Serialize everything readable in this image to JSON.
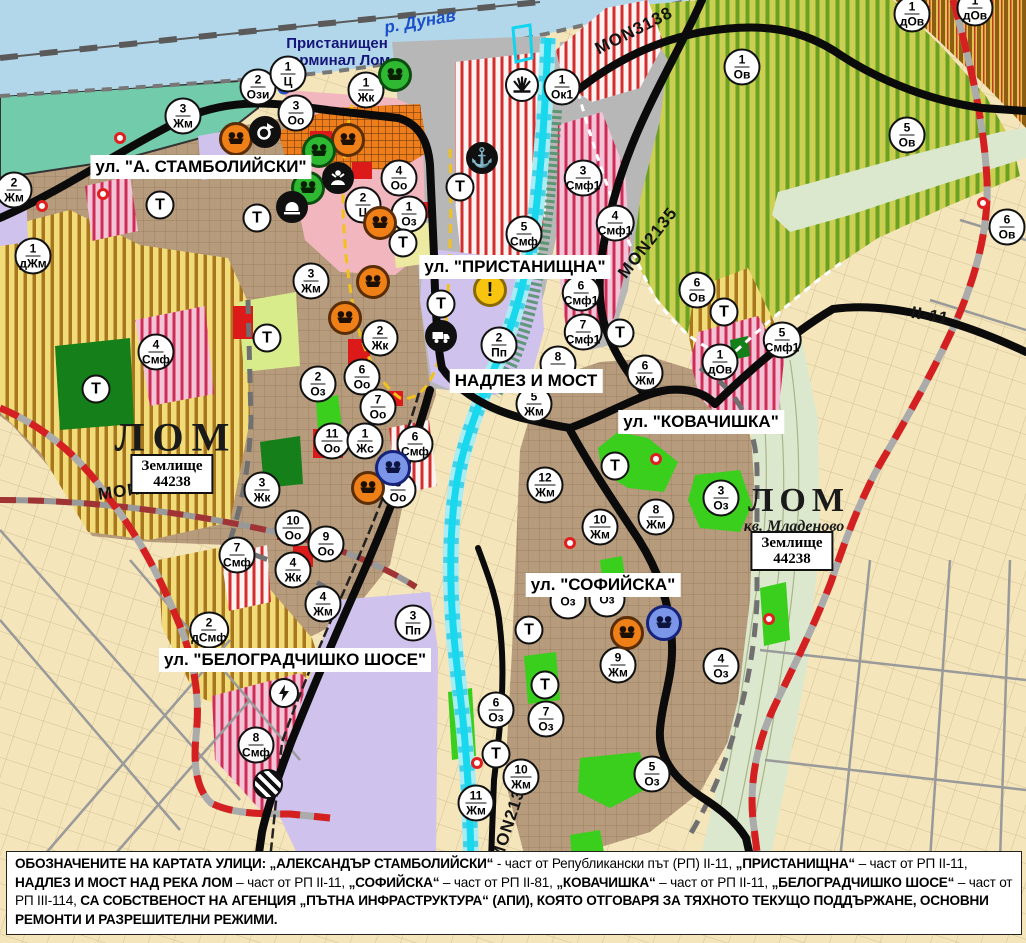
{
  "colors": {
    "orange_icon": "#ef8018",
    "green_icon": "#2fb832",
    "blue_icon": "#7b96e8",
    "warning_icon": "#f7c40f",
    "danube": "#b3d7ea",
    "lom_river": "#18d8ee",
    "red_dashed_road": "#d42020",
    "zone_red_stripe": "#d32d2d"
  },
  "map": {
    "river_label": "р. Дунав",
    "port_label_line1": "Пристанищен",
    "port_label_line2": "терминал Лом",
    "t_label": "Т",
    "towns": [
      {
        "name": "ЛОМ",
        "x": 176,
        "y": 437,
        "size": 40,
        "spacing": 8
      },
      {
        "name": "ЛОМ",
        "x": 799,
        "y": 501,
        "size": 34,
        "spacing": 6
      }
    ],
    "suburb": {
      "text": "кв. Младеново",
      "x": 794,
      "y": 527
    },
    "land_box": {
      "line1": "Землище",
      "line2": "44238"
    },
    "land_box_positions": [
      {
        "x": 172,
        "y": 474
      },
      {
        "x": 792,
        "y": 551
      }
    ],
    "street_labels": [
      {
        "text": "ул. \"А. СТАМБОЛИЙСКИ\"",
        "x": 201,
        "y": 167
      },
      {
        "text": "ул. \"ПРИСТАНИЩНА\"",
        "x": 515,
        "y": 267
      },
      {
        "text": "НАДЛЕЗ И МОСТ",
        "x": 526,
        "y": 381
      },
      {
        "text": "ул. \"КОВАЧИШКА\"",
        "x": 701,
        "y": 422
      },
      {
        "text": "ул. \"СОФИЙСКА\"",
        "x": 603,
        "y": 585
      },
      {
        "text": "ул. \"БЕЛОГРАДЧИШКО ШОСЕ\"",
        "x": 295,
        "y": 660
      }
    ],
    "road_labels": [
      {
        "text": "MON3139",
        "x": 140,
        "y": 489,
        "rot": -8
      },
      {
        "text": "MON3138",
        "x": 634,
        "y": 31,
        "rot": -27
      },
      {
        "text": "MON2135",
        "x": 648,
        "y": 243,
        "rot": -52
      },
      {
        "text": "MON2136",
        "x": 510,
        "y": 820,
        "rot": -72
      },
      {
        "text": "II-11",
        "x": 930,
        "y": 316,
        "rot": 10
      }
    ],
    "zone_markers": [
      {
        "n": "2",
        "c": "Жм",
        "x": 14,
        "y": 190
      },
      {
        "n": "1",
        "c": "дЖм",
        "x": 33,
        "y": 256
      },
      {
        "n": "3",
        "c": "Жм",
        "x": 183,
        "y": 116
      },
      {
        "n": "3",
        "c": "Оо",
        "x": 296,
        "y": 113
      },
      {
        "n": "2",
        "c": "Ози",
        "x": 258,
        "y": 87
      },
      {
        "n": "1",
        "c": "Ц",
        "x": 288,
        "y": 74
      },
      {
        "n": "1",
        "c": "Жк",
        "x": 366,
        "y": 90
      },
      {
        "n": "4",
        "c": "Оо",
        "x": 399,
        "y": 178
      },
      {
        "n": "2",
        "c": "Ц",
        "x": 363,
        "y": 205
      },
      {
        "n": "1",
        "c": "Оз",
        "x": 409,
        "y": 214
      },
      {
        "n": "3",
        "c": "Жм",
        "x": 311,
        "y": 281
      },
      {
        "n": "2",
        "c": "Жк",
        "x": 380,
        "y": 338
      },
      {
        "n": "2",
        "c": "Оз",
        "x": 318,
        "y": 384
      },
      {
        "n": "6",
        "c": "Оо",
        "x": 362,
        "y": 377
      },
      {
        "n": "7",
        "c": "Оо",
        "x": 378,
        "y": 407
      },
      {
        "n": "11",
        "c": "Оо",
        "x": 332,
        "y": 441
      },
      {
        "n": "1",
        "c": "Жс",
        "x": 365,
        "y": 441
      },
      {
        "n": "6",
        "c": "Смф",
        "x": 415,
        "y": 444
      },
      {
        "n": "8",
        "c": "Оо",
        "x": 398,
        "y": 490
      },
      {
        "n": "3",
        "c": "Жк",
        "x": 262,
        "y": 490
      },
      {
        "n": "10",
        "c": "Оо",
        "x": 293,
        "y": 528
      },
      {
        "n": "9",
        "c": "Оо",
        "x": 326,
        "y": 544
      },
      {
        "n": "4",
        "c": "Жк",
        "x": 293,
        "y": 570
      },
      {
        "n": "7",
        "c": "Смф",
        "x": 237,
        "y": 555
      },
      {
        "n": "4",
        "c": "Смф",
        "x": 156,
        "y": 352
      },
      {
        "n": "2",
        "c": "дСмф",
        "x": 209,
        "y": 630
      },
      {
        "n": "4",
        "c": "Жм",
        "x": 323,
        "y": 604
      },
      {
        "n": "3",
        "c": "Пп",
        "x": 413,
        "y": 623
      },
      {
        "n": "8",
        "c": "Смф",
        "x": 256,
        "y": 745
      },
      {
        "n": "1",
        "c": "Ок1",
        "x": 562,
        "y": 87
      },
      {
        "n": "3",
        "c": "Смф1",
        "x": 583,
        "y": 178
      },
      {
        "n": "5",
        "c": "Смф",
        "x": 524,
        "y": 234
      },
      {
        "n": "4",
        "c": "Смф1",
        "x": 615,
        "y": 223
      },
      {
        "n": "6",
        "c": "Смф1",
        "x": 581,
        "y": 293
      },
      {
        "n": "7",
        "c": "Смф1",
        "x": 583,
        "y": 332
      },
      {
        "n": "2",
        "c": "Пп",
        "x": 499,
        "y": 345
      },
      {
        "n": "8",
        "c": "",
        "x": 558,
        "y": 364
      },
      {
        "n": "5",
        "c": "Жм",
        "x": 534,
        "y": 404
      },
      {
        "n": "12",
        "c": "Жм",
        "x": 545,
        "y": 485
      },
      {
        "n": "10",
        "c": "Жм",
        "x": 600,
        "y": 527
      },
      {
        "n": "8",
        "c": "Жм",
        "x": 656,
        "y": 517
      },
      {
        "n": "6",
        "c": "Жм",
        "x": 645,
        "y": 373
      },
      {
        "n": "3",
        "c": "Оз",
        "x": 721,
        "y": 498
      },
      {
        "n": "1",
        "c": "Ов",
        "x": 742,
        "y": 67
      },
      {
        "n": "5",
        "c": "Ов",
        "x": 907,
        "y": 135
      },
      {
        "n": "1",
        "c": "дОв",
        "x": 912,
        "y": 14
      },
      {
        "n": "1",
        "c": "дОв",
        "x": 975,
        "y": 8
      },
      {
        "n": "6",
        "c": "Ов",
        "x": 697,
        "y": 290
      },
      {
        "n": "6",
        "c": "Ов",
        "x": 1007,
        "y": 227
      },
      {
        "n": "1",
        "c": "дОв",
        "x": 720,
        "y": 362
      },
      {
        "n": "5",
        "c": "Смф1",
        "x": 782,
        "y": 340
      },
      {
        "n": "9",
        "c": "Жм",
        "x": 618,
        "y": 665
      },
      {
        "n": "6",
        "c": "Оз",
        "x": 496,
        "y": 710
      },
      {
        "n": "7",
        "c": "Оз",
        "x": 546,
        "y": 719
      },
      {
        "n": "10",
        "c": "Жм",
        "x": 521,
        "y": 777
      },
      {
        "n": "11",
        "c": "Жм",
        "x": 476,
        "y": 803
      },
      {
        "n": "5",
        "c": "Оз",
        "x": 652,
        "y": 774
      },
      {
        "n": "4",
        "c": "Оз",
        "x": 721,
        "y": 666
      },
      {
        "n": "",
        "c": "Оз",
        "x": 568,
        "y": 601
      },
      {
        "n": "",
        "c": "Оз",
        "x": 607,
        "y": 599
      }
    ],
    "t_markers": [
      {
        "x": 160,
        "y": 205
      },
      {
        "x": 257,
        "y": 218
      },
      {
        "x": 267,
        "y": 338
      },
      {
        "x": 96,
        "y": 389
      },
      {
        "x": 403,
        "y": 243
      },
      {
        "x": 460,
        "y": 187
      },
      {
        "x": 441,
        "y": 304
      },
      {
        "x": 620,
        "y": 333
      },
      {
        "x": 724,
        "y": 312
      },
      {
        "x": 615,
        "y": 466
      },
      {
        "x": 529,
        "y": 630
      },
      {
        "x": 545,
        "y": 685
      },
      {
        "x": 496,
        "y": 754
      }
    ],
    "poi_icons": [
      {
        "type": "monument-orange",
        "x": 236,
        "y": 139
      },
      {
        "type": "monument-orange",
        "x": 348,
        "y": 140
      },
      {
        "type": "monument-orange",
        "x": 380,
        "y": 223
      },
      {
        "type": "monument-orange",
        "x": 373,
        "y": 282
      },
      {
        "type": "monument-orange",
        "x": 345,
        "y": 318
      },
      {
        "type": "monument-orange",
        "x": 368,
        "y": 488
      },
      {
        "type": "monument-orange",
        "x": 627,
        "y": 633
      },
      {
        "type": "monument-green",
        "x": 395,
        "y": 75
      },
      {
        "type": "monument-green",
        "x": 319,
        "y": 151
      },
      {
        "type": "monument-green",
        "x": 308,
        "y": 188
      },
      {
        "type": "monument-blue",
        "x": 393,
        "y": 468
      },
      {
        "type": "monument-blue",
        "x": 664,
        "y": 623
      },
      {
        "type": "anchor",
        "x": 482,
        "y": 158
      },
      {
        "type": "roundabout",
        "x": 265,
        "y": 132
      },
      {
        "type": "person",
        "x": 338,
        "y": 178
      },
      {
        "type": "tunnel",
        "x": 292,
        "y": 207
      },
      {
        "type": "truck",
        "x": 441,
        "y": 336
      },
      {
        "type": "fan",
        "x": 522,
        "y": 85
      },
      {
        "type": "warning",
        "x": 490,
        "y": 290
      },
      {
        "type": "lightning",
        "x": 284,
        "y": 693
      },
      {
        "type": "striped-post",
        "x": 268,
        "y": 784
      },
      {
        "type": "blue-ring",
        "x": 284,
        "y": 88
      },
      {
        "type": "red-dot",
        "x": 120,
        "y": 138
      },
      {
        "type": "red-dot",
        "x": 103,
        "y": 194
      },
      {
        "type": "red-dot",
        "x": 42,
        "y": 206
      },
      {
        "type": "red-dot",
        "x": 656,
        "y": 459
      },
      {
        "type": "red-dot",
        "x": 570,
        "y": 543
      },
      {
        "type": "red-dot",
        "x": 477,
        "y": 763
      },
      {
        "type": "red-dot",
        "x": 769,
        "y": 619
      },
      {
        "type": "red-dot",
        "x": 983,
        "y": 203
      }
    ]
  },
  "footer": {
    "segments": [
      {
        "bold": true,
        "text": "ОБОЗНАЧЕНИТЕ НА КАРТАТА УЛИЦИ: „АЛЕКСАНДЪР СТАМБОЛИЙСКИ“"
      },
      {
        "bold": false,
        "text": " - част от Републикански път (РП) II-11, "
      },
      {
        "bold": true,
        "text": "„ПРИСТАНИЩНА“"
      },
      {
        "bold": false,
        "text": " – част от РП II-11, "
      },
      {
        "bold": true,
        "text": "НАДЛЕЗ И МОСТ НАД РЕКА ЛОМ"
      },
      {
        "bold": false,
        "text": " – част от РП II-11, "
      },
      {
        "bold": true,
        "text": "„СОФИЙСКА“"
      },
      {
        "bold": false,
        "text": " – част от РП II-81, "
      },
      {
        "bold": true,
        "text": "„КОВАЧИШКА“"
      },
      {
        "bold": false,
        "text": " – част от РП II-11, "
      },
      {
        "bold": true,
        "text": "„БЕЛОГРАДЧИШКО ШОСЕ“"
      },
      {
        "bold": false,
        "text": " – част от РП III-114, "
      },
      {
        "bold": true,
        "text": "СА СОБСТВЕНОСТ НА АГЕНЦИЯ „ПЪТНА ИНФРАСТРУКТУРА“ (АПИ), КОЯТО ОТГОВАРЯ ЗА ТЯХНОТО ТЕКУЩО ПОДДЪРЖАНЕ, ОСНОВНИ РЕМОНТИ И РАЗРЕШИТЕЛНИ РЕЖИМИ."
      }
    ]
  }
}
